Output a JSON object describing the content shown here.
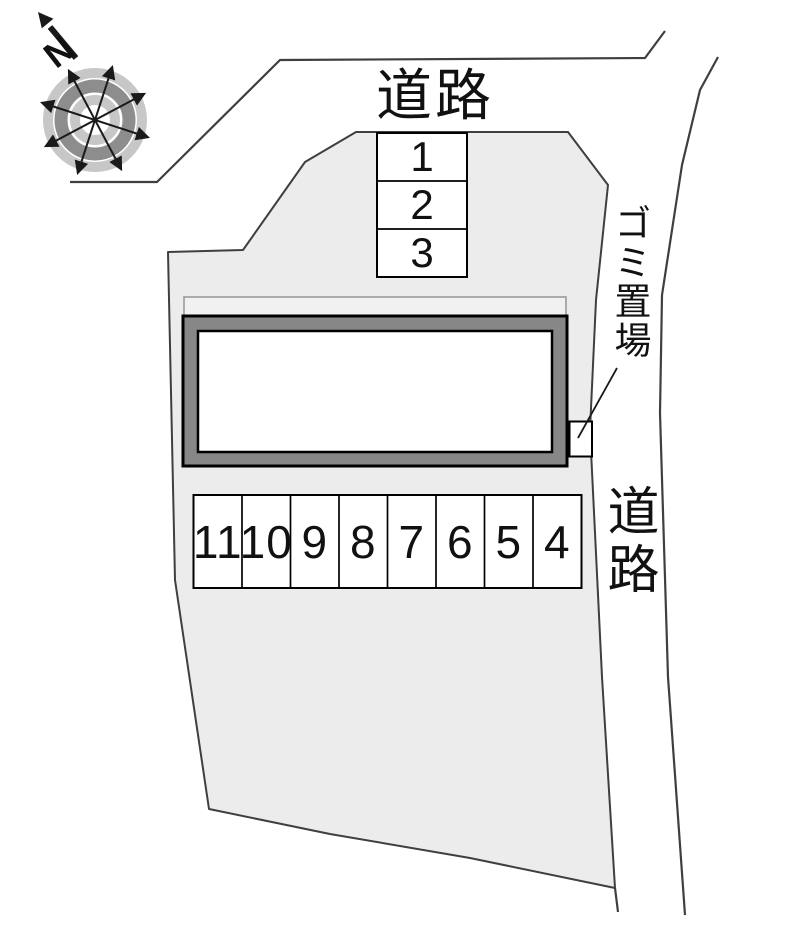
{
  "site_plan": {
    "compass": {
      "north_label": "N"
    },
    "top_road": {
      "label": "道路"
    },
    "right_road": {
      "label": "道路"
    },
    "garbage_area": {
      "label": "ゴミ置場"
    },
    "stalls": {
      "top_column": [
        "1",
        "2",
        "3"
      ],
      "bottom_row": [
        "11",
        "10",
        "9",
        "8",
        "7",
        "6",
        "5",
        "4"
      ]
    },
    "colors": {
      "property_fill": "#ececec",
      "boundary_line": "#3f3f3f",
      "building_band": "#878787",
      "building_inner": "#ffffff",
      "back_structure_fill": "#f1f1f1",
      "back_structure_line": "#9a9a9a",
      "compass_ring_light": "#c7c7c7",
      "compass_ring_dark": "#8d8d8d",
      "ink": "#111111"
    }
  }
}
